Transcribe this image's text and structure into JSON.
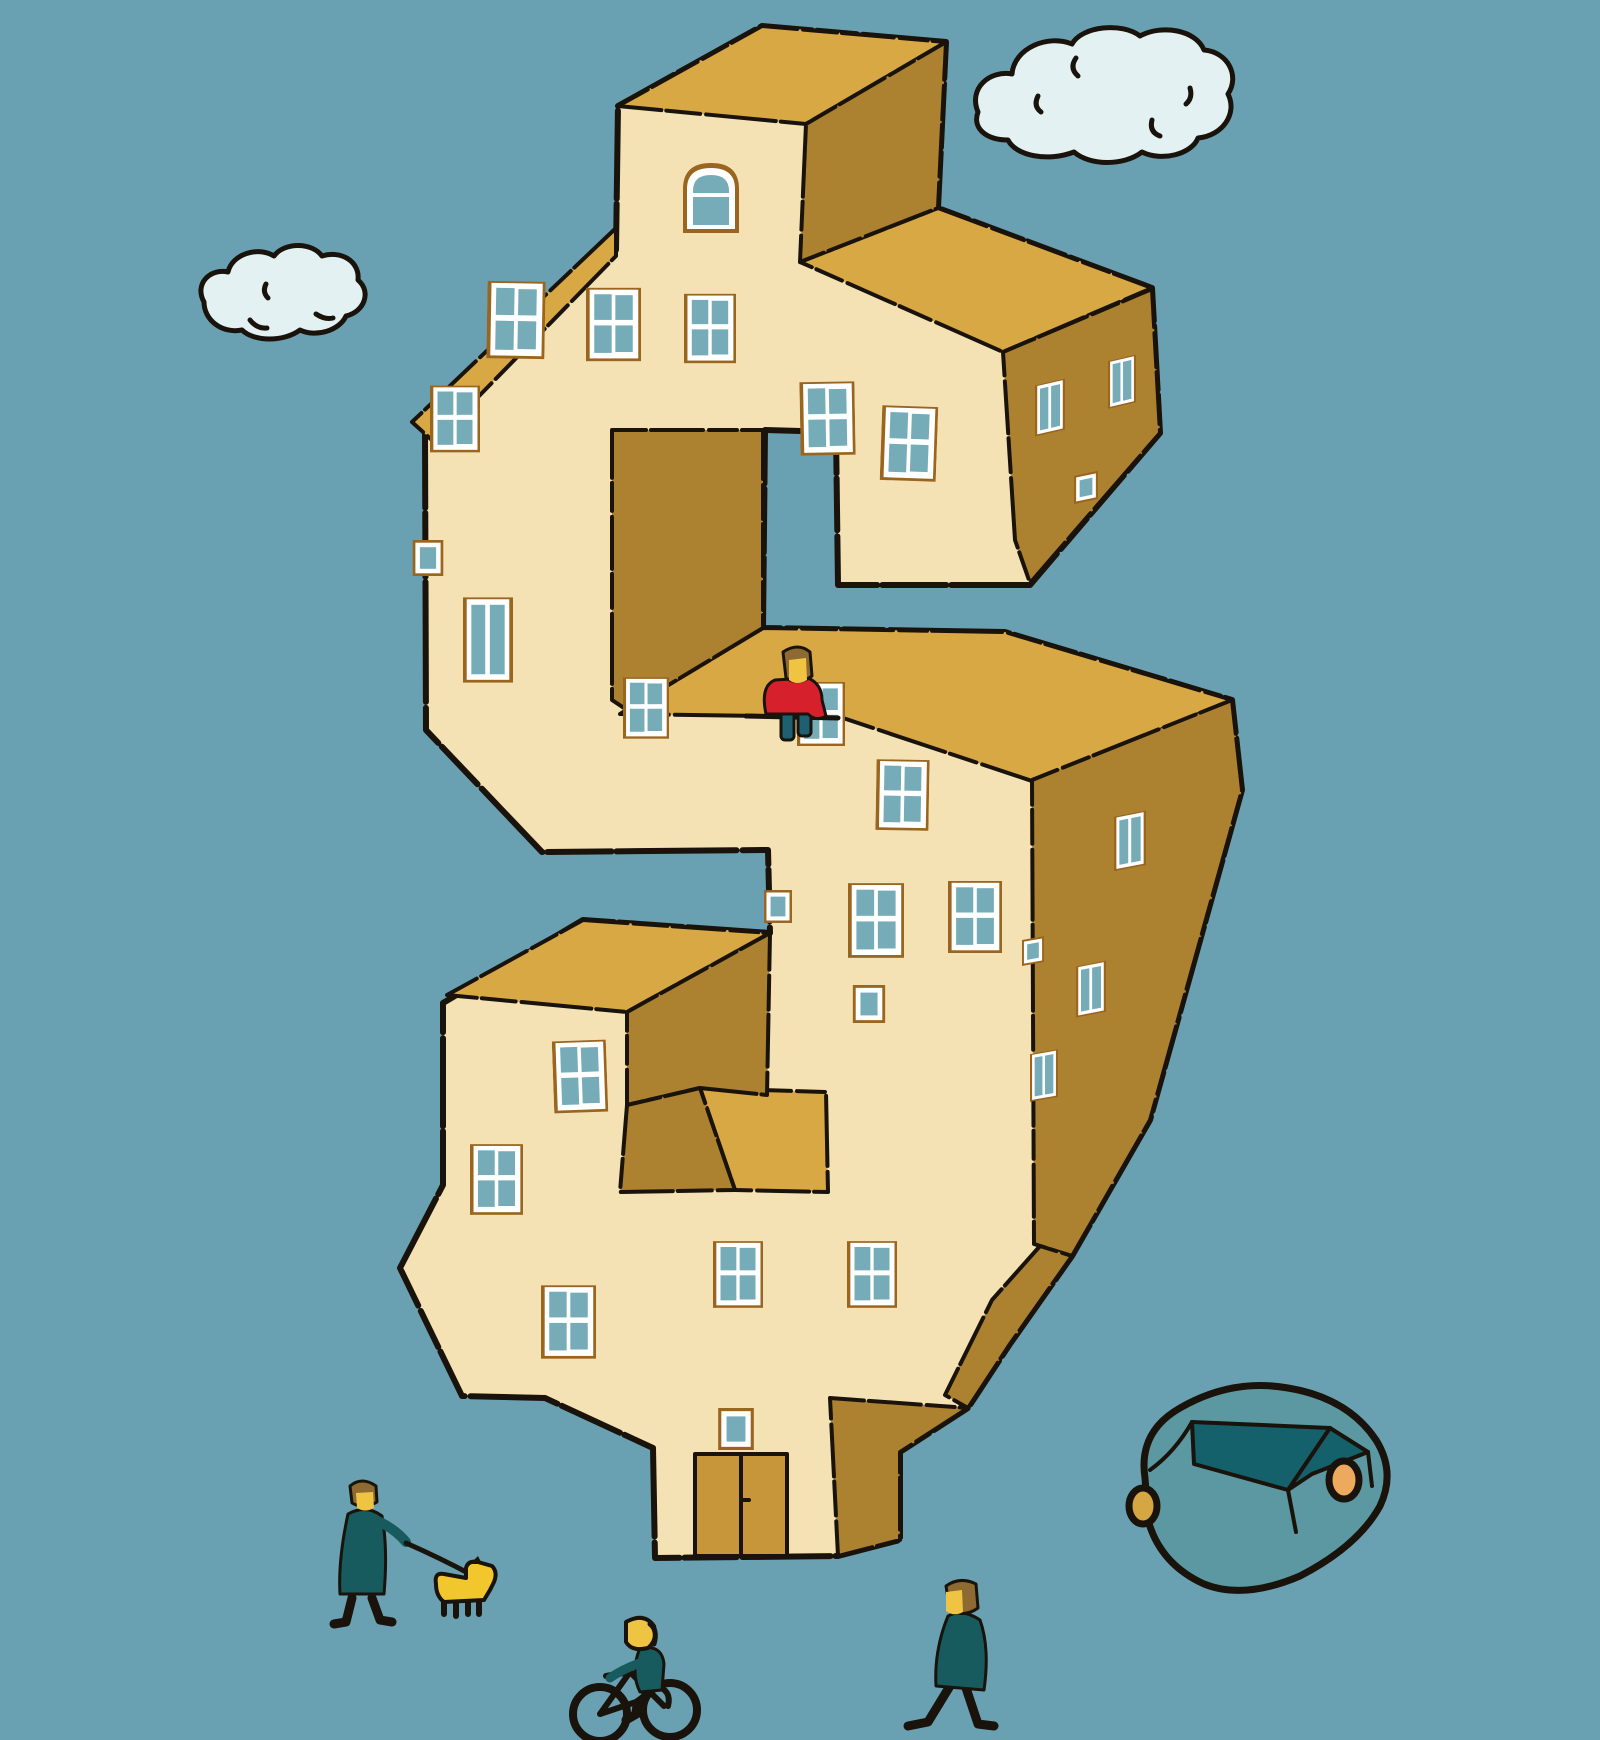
{
  "scene": {
    "description": "Flat hand-drawn illustration of a giant three-dimensional dollar-sign shaped apartment building with many windows, standing under a teal sky with two clouds. A person in a red sweater sits on a ledge of the S, a person walks a yellow dog, a cyclist rides a bicycle, a pedestrian walks, and a teal car is parked at the lower right.",
    "labels": {
      "sky": "teal sky background",
      "cloud_right": "large cloud upper right",
      "cloud_left": "small cloud upper left",
      "building": "dollar-sign shaped apartment building",
      "tower": "rooftop tower with arched window",
      "windows": "building windows",
      "door": "double entrance door at base",
      "sitting_person": "person in red sweater sitting on ledge",
      "dog_walker": "person in dark coat walking a dog",
      "dog": "small yellow dog on leash",
      "leash": "dog leash",
      "cyclist": "person riding a bicycle",
      "pedestrian": "person walking",
      "car": "teal car parked at lower right"
    }
  },
  "colors": {
    "sky": "#6AA1B2",
    "cloud": "#E3F1F2",
    "outline": "#19130B",
    "wall_front": "#F4E2B4",
    "wall_top": "#D8A844",
    "wall_side": "#AC8230",
    "window_trim": "#9A651E",
    "window_frame": "#FFFFFF",
    "window_glass": "#76ACB8",
    "door": "#C8963A",
    "person_top_red": "#D6202B",
    "person_pants": "#1E5F70",
    "person_skin": "#F0C443",
    "person_hair": "#8E6A33",
    "person_coat": "#175B5E",
    "dog": "#F2C72E",
    "car_body": "#5C98A1",
    "car_glass": "#14616C",
    "wheel_yellow": "#D5A743",
    "wheel_orange": "#EDAA5E"
  }
}
